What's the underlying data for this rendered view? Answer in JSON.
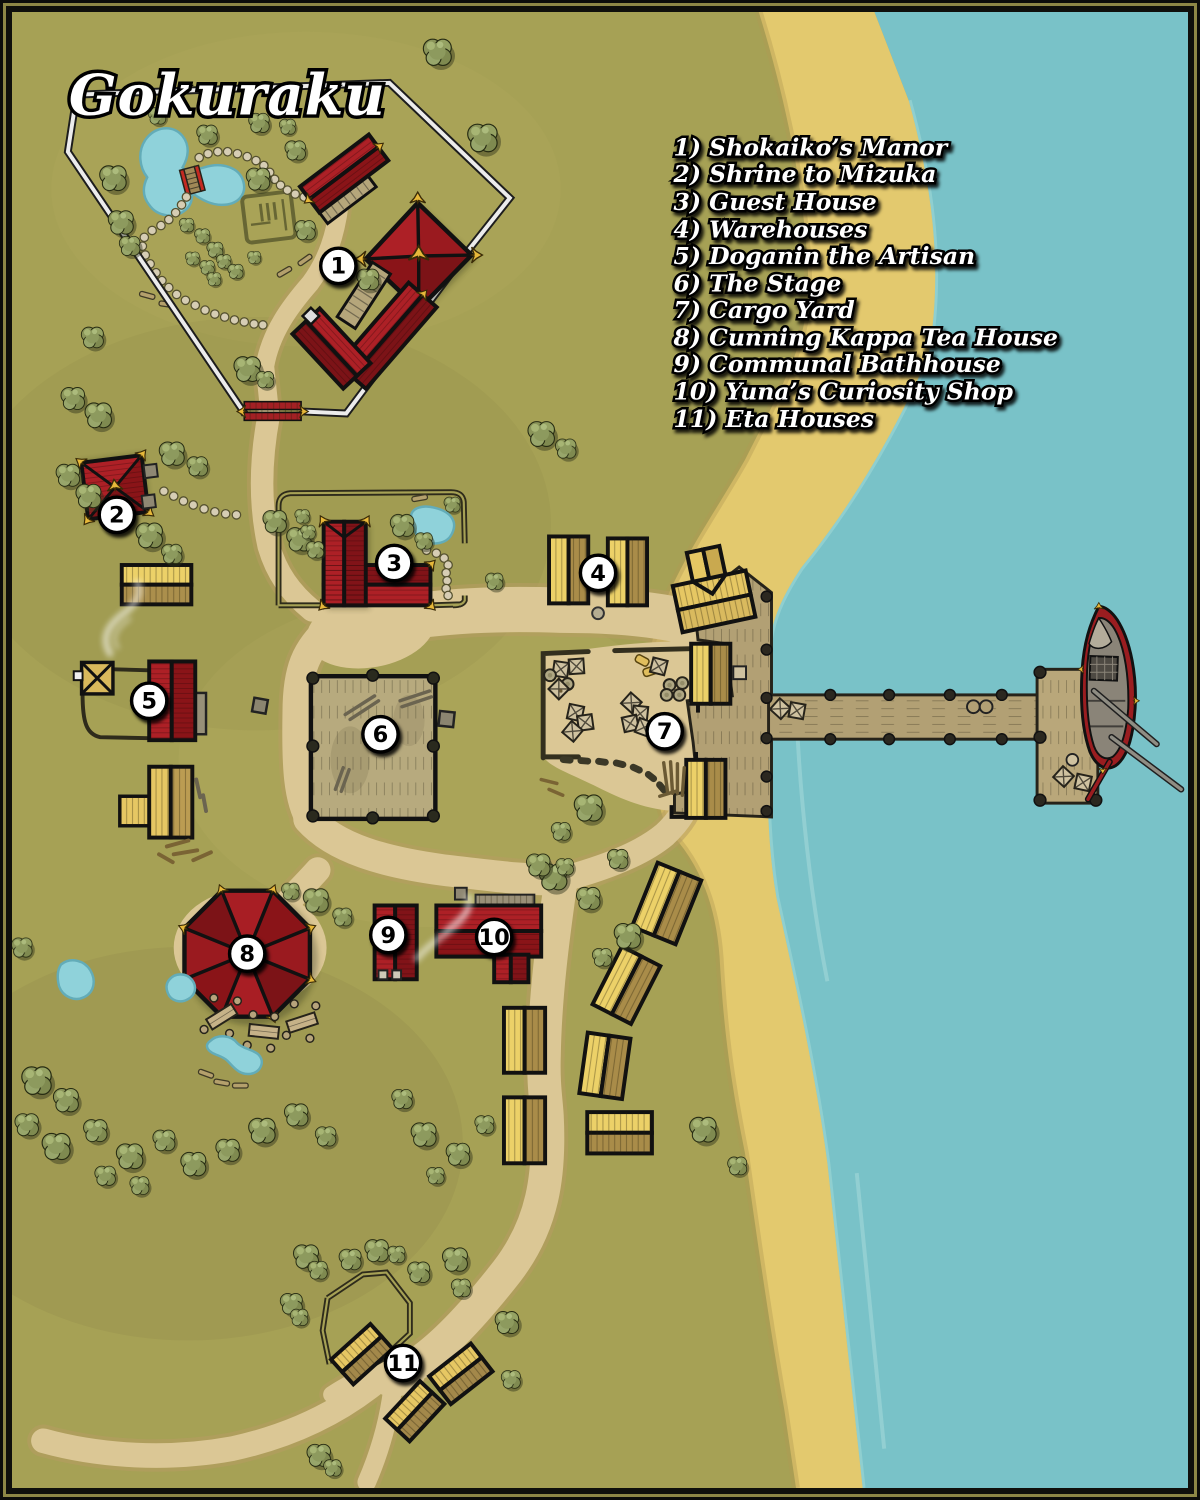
{
  "title": "Gokuraku",
  "legend": {
    "items": [
      "1) Shokaiko’s Manor",
      "2) Shrine to Mizuka",
      "3) Guest House",
      "4) Warehouses",
      "5) Doganin the Artisan",
      "6) The Stage",
      "7) Cargo Yard",
      "8) Cunning Kappa Tea House",
      "9) Communal Bathhouse",
      "10) Yuna’s Curiosity Shop",
      "11) Eta Houses"
    ]
  },
  "markers": [
    {
      "number": "1",
      "label": "Shokaiko’s Manor"
    },
    {
      "number": "2",
      "label": "Shrine to Mizuka"
    },
    {
      "number": "3",
      "label": "Guest House"
    },
    {
      "number": "4",
      "label": "Warehouses"
    },
    {
      "number": "5",
      "label": "Doganin the Artisan"
    },
    {
      "number": "6",
      "label": "The Stage"
    },
    {
      "number": "7",
      "label": "Cargo Yard"
    },
    {
      "number": "8",
      "label": "Cunning Kappa Tea House"
    },
    {
      "number": "9",
      "label": "Communal Bathhouse"
    },
    {
      "number": "10",
      "label": "Yuna’s Curiosity Shop"
    },
    {
      "number": "11",
      "label": "Eta Houses"
    }
  ],
  "colors": {
    "water": "#79c2c8",
    "sand": "#e3c96e",
    "grass": "#a6a155",
    "path": "#dbc795",
    "roof_red": "#ad2026",
    "roof_red_dark": "#7c1317",
    "wood_yellow": "#ecd168",
    "wood_tan": "#a98c49",
    "wood_gray": "#b2a074",
    "gold": "#e7b83a",
    "marker_bg": "#ffffff",
    "marker_text": "#000000",
    "fence_white": "#ececec"
  }
}
